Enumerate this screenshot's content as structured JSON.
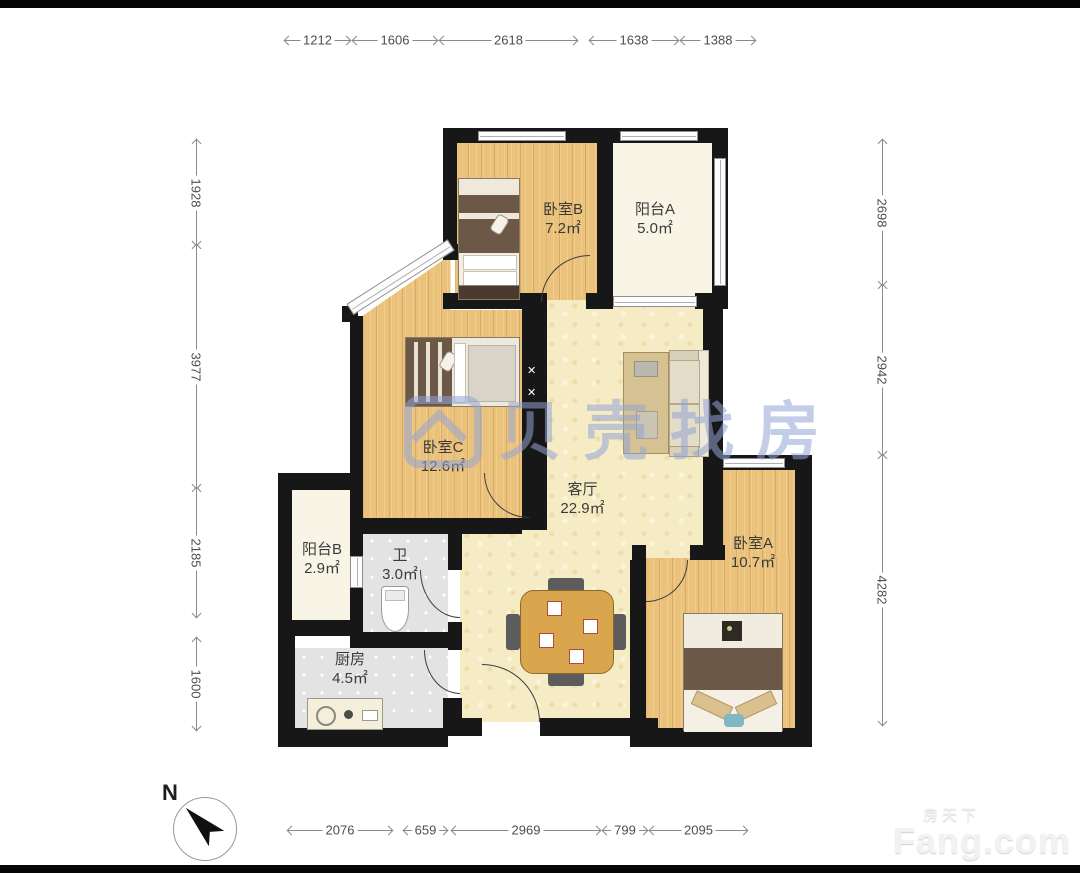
{
  "watermark": {
    "text": "贝壳找房",
    "color": "rgba(148,164,214,0.55)"
  },
  "brand": {
    "small": "房天下",
    "big": "Fang.com"
  },
  "compass": {
    "label": "N"
  },
  "colors": {
    "wall": "#171717",
    "wood_floor": "#eac27c",
    "living_floor": "#f5ecc6",
    "balcony_floor": "#f8f5e6",
    "tile_floor": "#e3e3e3"
  },
  "rooms": [
    {
      "id": "bedroom-b",
      "name": "卧室B",
      "area": "7.2㎡"
    },
    {
      "id": "balcony-a",
      "name": "阳台A",
      "area": "5.0㎡"
    },
    {
      "id": "bedroom-c",
      "name": "卧室C",
      "area": "12.6㎡"
    },
    {
      "id": "living-room",
      "name": "客厅",
      "area": "22.9㎡"
    },
    {
      "id": "bedroom-a",
      "name": "卧室A",
      "area": "10.7㎡"
    },
    {
      "id": "balcony-b",
      "name": "阳台B",
      "area": "2.9㎡"
    },
    {
      "id": "bathroom",
      "name": "卫",
      "area": "3.0㎡"
    },
    {
      "id": "kitchen",
      "name": "厨房",
      "area": "4.5㎡"
    }
  ],
  "dimensions": {
    "top": [
      "1212",
      "1606",
      "2618",
      "1638",
      "1388"
    ],
    "left": [
      "1928",
      "3977",
      "2185",
      "1600"
    ],
    "right": [
      "2698",
      "2942",
      "4282"
    ],
    "bottom": [
      "2076",
      "659",
      "2969",
      "799",
      "2095"
    ]
  }
}
